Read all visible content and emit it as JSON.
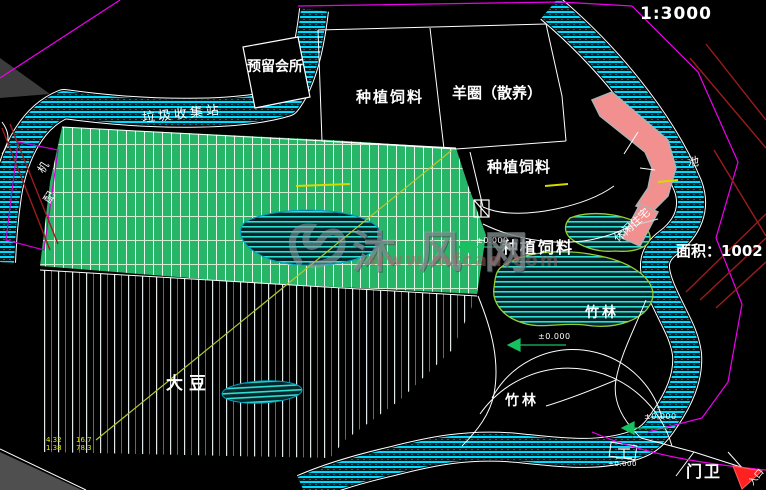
{
  "scale": {
    "label": "1:3000"
  },
  "watermark": {
    "brand": "沐风网",
    "url": "www.mfcad.com",
    "logo": "mufeng-swirl-logo"
  },
  "area_note": {
    "text": "面积：1002"
  },
  "labels": {
    "reserved_clubhouse": "预留会所",
    "garbage_station": "垃圾收集站",
    "feed_top": "种植饲料",
    "sheep_pen": "羊圈（散养）",
    "feed_mid": "种植饲料",
    "feed_lower": "种植饲料",
    "soybean": "大豆",
    "bamboo_upper": "竹林",
    "bamboo_lower": "竹林",
    "gatehouse": "门卫",
    "pond": "池",
    "leisure": "休闲住宅",
    "entrance": "入口",
    "machine1": "机",
    "machine2": "配"
  },
  "elevation": {
    "marker": "±0.000"
  },
  "dims": {
    "a1": "4.32",
    "a2": "1.38",
    "b1": "16.7",
    "b2": "78.3"
  },
  "colors": {
    "water": "#00dcff",
    "field_green": "#27b568",
    "building_pink": "#f29090",
    "boundary_magenta": "#ff00ff",
    "road_red": "#9b1c1c",
    "path_yellow": "#b6c832",
    "marker_green": "#19c060",
    "entrance_red": "#ff2020"
  }
}
